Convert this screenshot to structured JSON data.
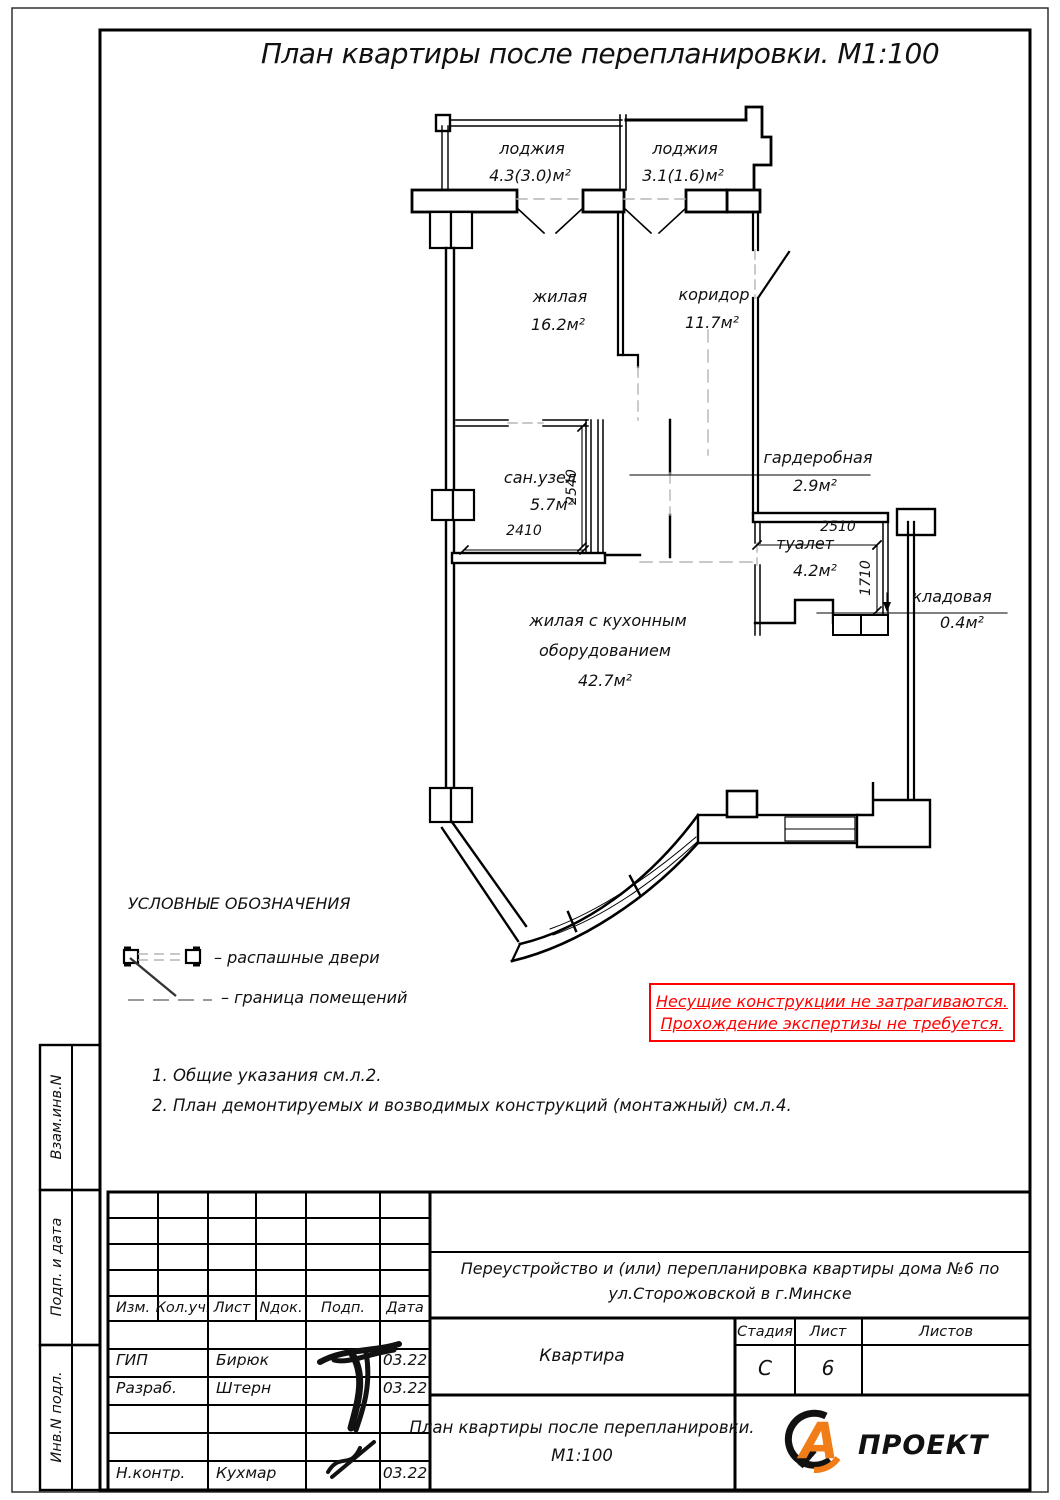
{
  "sheet": {
    "title": "План квартиры после перепланировки. М1:100"
  },
  "plan": {
    "rooms": [
      {
        "name": "лоджия",
        "area": "4.3(3.0)м²"
      },
      {
        "name": "лоджия",
        "area": "3.1(1.6)м²"
      },
      {
        "name": "жилая",
        "area": "16.2м²"
      },
      {
        "name": "коридор",
        "area": "11.7м²"
      },
      {
        "name": "сан.узел",
        "area": "5.7м²"
      },
      {
        "name": "гардеробная",
        "area": "2.9м²"
      },
      {
        "name": "туалет",
        "area": "4.2м²"
      },
      {
        "name": "кладовая",
        "area": "0.4м²"
      },
      {
        "name": "жилая с кухонным оборудованием",
        "name_line1": "жилая с кухонным",
        "name_line2": "оборудованием",
        "area": "42.7м²"
      }
    ],
    "dimensions": {
      "sanuzel_w": "2410",
      "sanuzel_h": "2540",
      "toilet_w": "2510",
      "toilet_h": "1710"
    }
  },
  "legend": {
    "title": "УСЛОВНЫЕ ОБОЗНАЧЕНИЯ",
    "items": [
      {
        "symbol": "swing-doors",
        "label": "– распашные двери"
      },
      {
        "symbol": "room-boundary",
        "label": "– граница помещений"
      }
    ]
  },
  "warning": {
    "line1": "Несущие конструкции не затрагиваются.",
    "line2": "Прохождение экспертизы не требуется.",
    "color": "#ff0000"
  },
  "notes": {
    "note1": "1. Общие указания см.л.2.",
    "note2": "2. План демонтируемых и возводимых конструкций (монтажный) см.л.4."
  },
  "sidebar": {
    "box1": "Взам.инв.N",
    "box2": "Подп. и дата",
    "box3": "Инв.N подл."
  },
  "stamp": {
    "headers": {
      "izm": "Изм.",
      "kol": "Кол.уч.",
      "list": "Лист",
      "ndok": "Nдок.",
      "podp": "Подп.",
      "data": "Дата"
    },
    "rows": [
      {
        "role": "ГИП",
        "name": "Бирюк",
        "date": "03.22"
      },
      {
        "role": "Разраб.",
        "name": "Штерн",
        "date": "03.22"
      },
      {
        "role": "Н.контр.",
        "name": "Кухмар",
        "date": "03.22"
      }
    ],
    "project": "Переустройство и (или) перепланировка квартиры дома №6 по ул.Сторожовской в г.Минске",
    "object_name": "Квартира",
    "stage_label": "Стадия",
    "sheet_label": "Лист",
    "sheets_label": "Листов",
    "stage_value": "С",
    "sheet_value": "6",
    "sheets_total": "",
    "doc_title": "План квартиры после перепланировки.",
    "doc_scale": "М1:100",
    "logo_letter": "А",
    "logo_text": "ПРОЕКТ",
    "logo_color": "#F07D17"
  }
}
